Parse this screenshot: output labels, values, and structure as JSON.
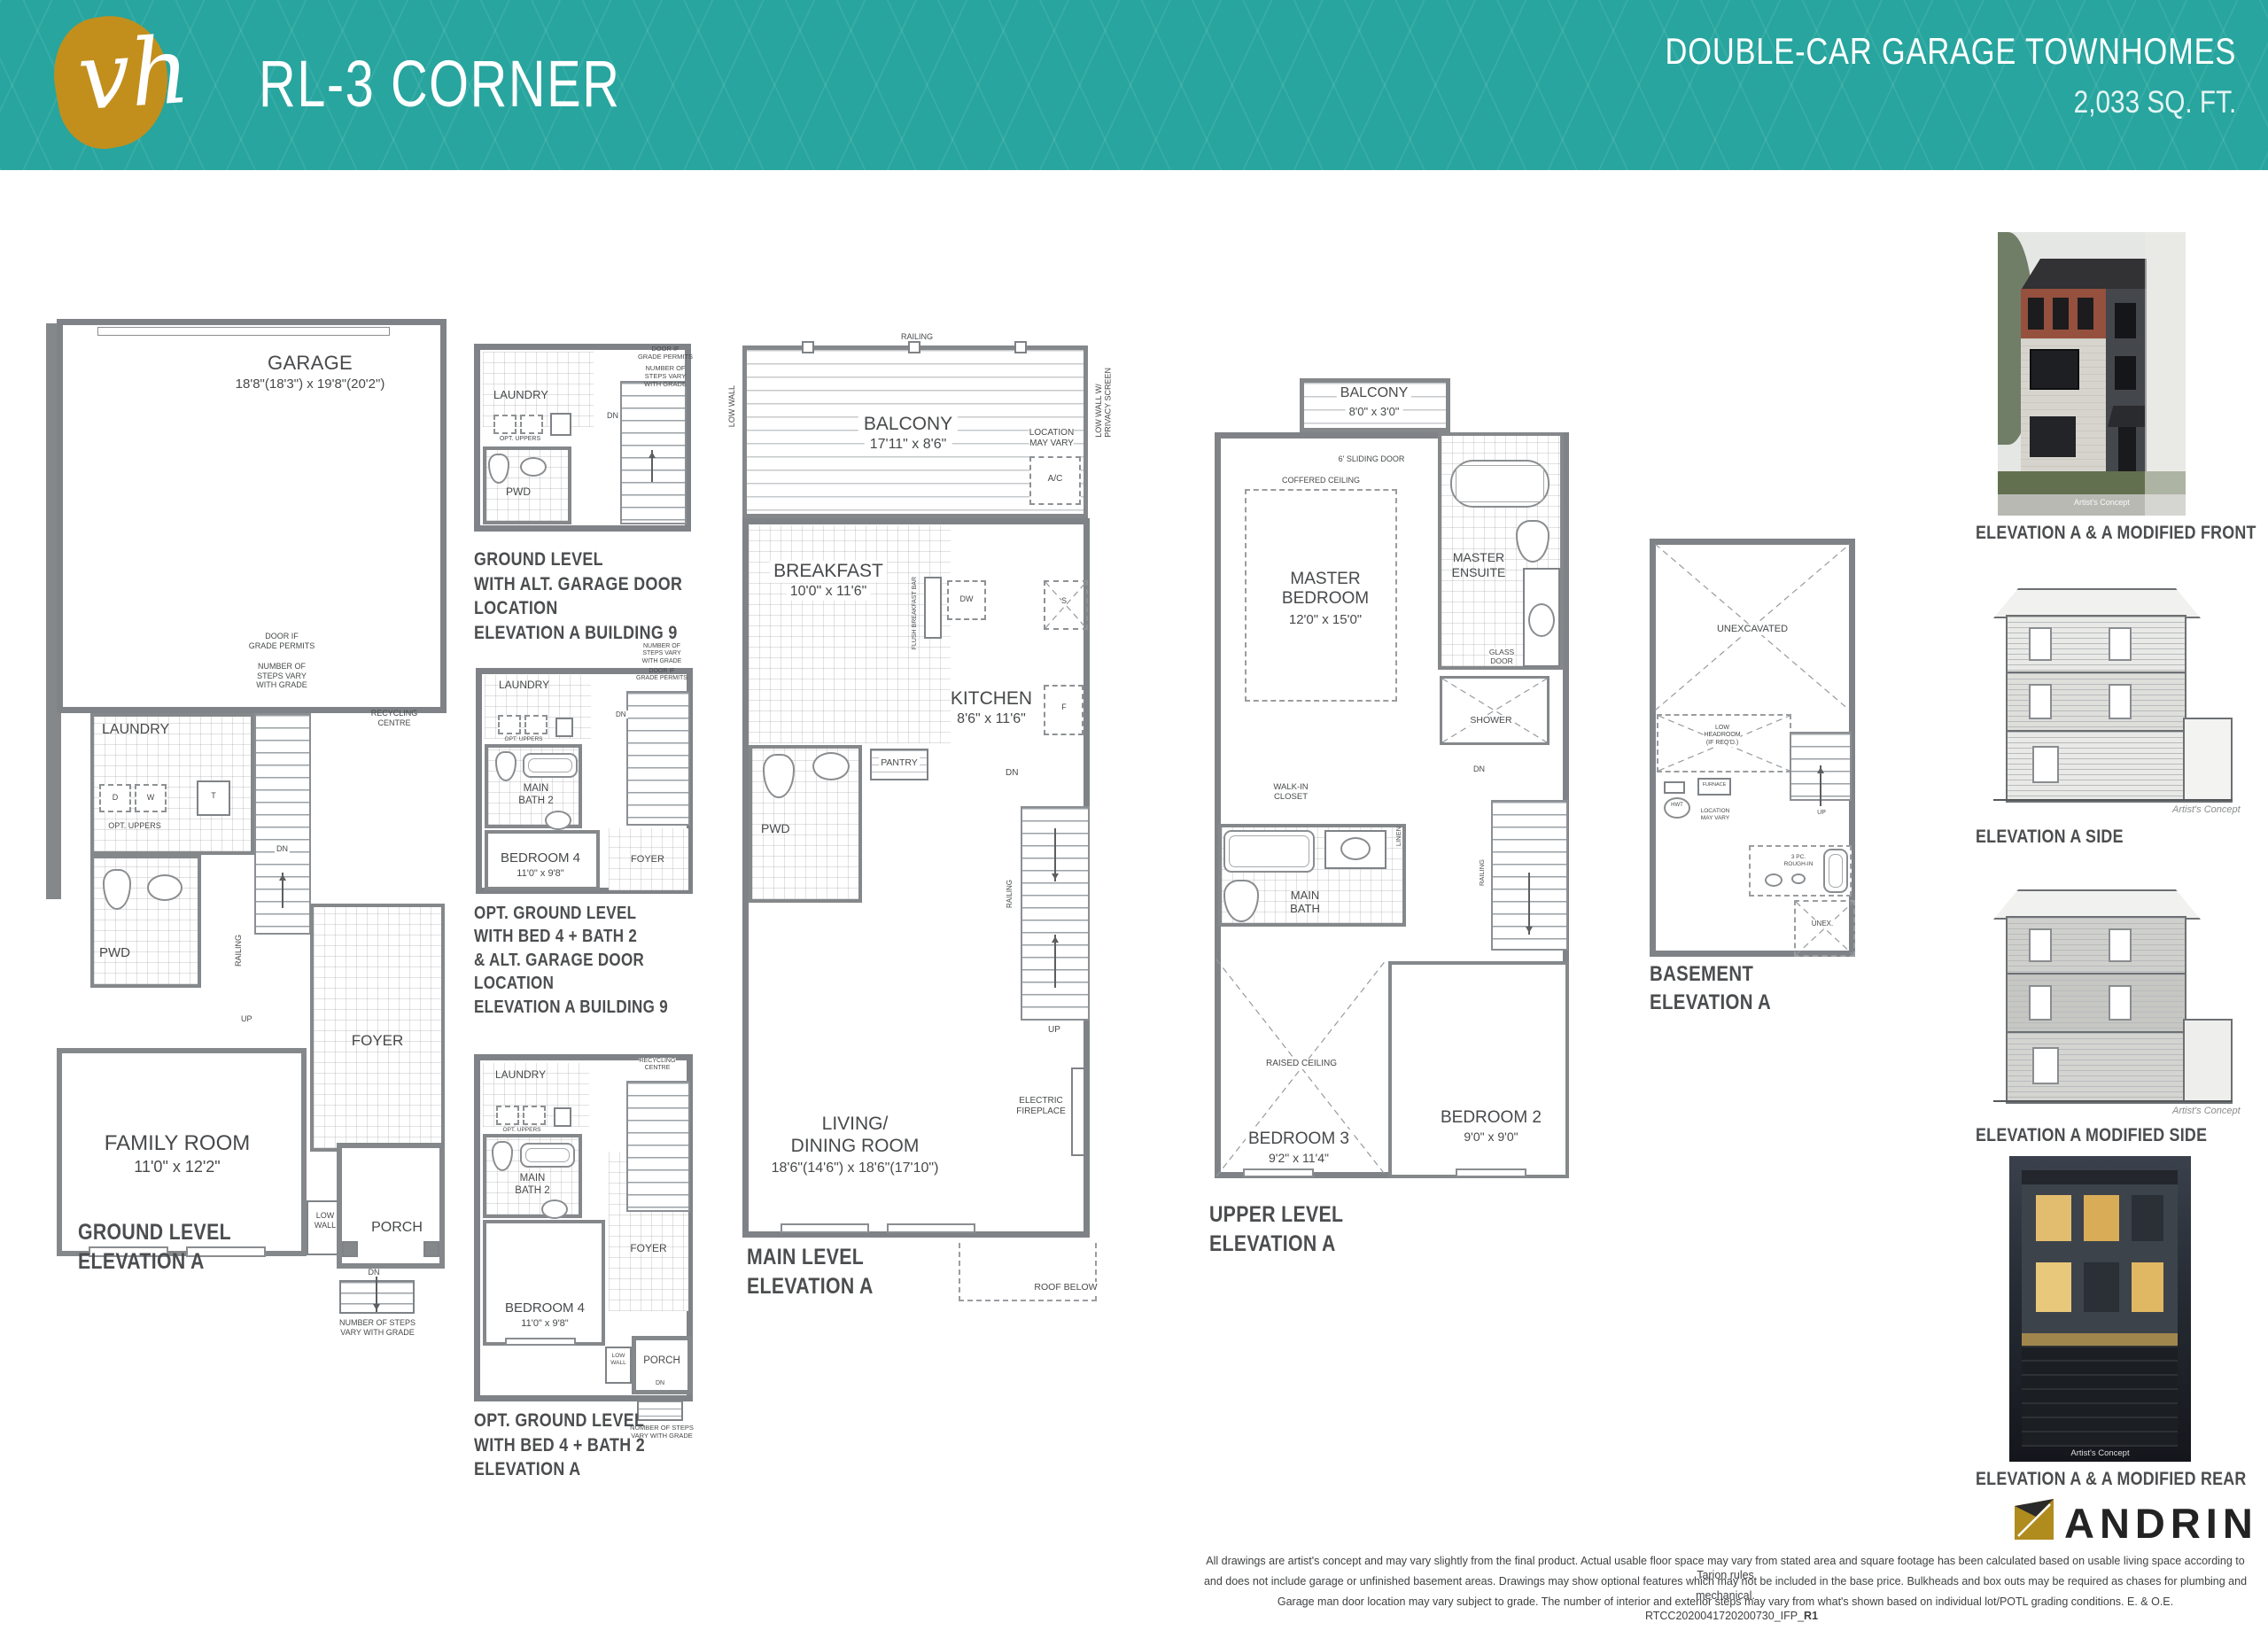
{
  "header": {
    "logo_text": "vh",
    "title": "RL-3 CORNER",
    "product": "DOUBLE-CAR GARAGE TOWNHOMES",
    "area": "2,033 SQ. FT."
  },
  "colors": {
    "teal": "#27a59e",
    "gold": "#c28f1d",
    "wall_gray": "#7f8387",
    "andrin_gold": "#b08c1e"
  },
  "common": {
    "laundry": "LAUNDRY",
    "pwd": "PWD",
    "foyer": "FOYER",
    "porch": "PORCH",
    "balcony": "BALCONY",
    "dn": "DN",
    "up": "UP",
    "railing": "RAILING",
    "d": "D",
    "w": "W",
    "t": "T",
    "f": "F",
    "s": "S",
    "dw": "DW",
    "opt_uppers": "OPT. UPPERS",
    "low_wall": "LOW\nWALL",
    "half_wall": "HALF\nWALL",
    "steps_vary": "NUMBER OF\nSTEPS VARY\nWITH GRADE",
    "steps_vary_wide": "NUMBER OF STEPS\nVARY WITH GRADE",
    "door_grade": "DOOR IF\nGRADE PERMITS",
    "recycling": "RECYCLING\nCENTRE",
    "main_bath2": "MAIN\nBATH 2",
    "bedroom4": "BEDROOM 4",
    "bedroom4_dims": "11'0\" x 9'8\"",
    "sliding_door": "6' SLIDING DOOR",
    "artists_concept": "Artist's Concept"
  },
  "ground": {
    "garage": "GARAGE",
    "garage_dims": "18'8\"(18'3\") x 19'8\"(20'2\")",
    "family": "FAMILY ROOM",
    "family_dims": "11'0\" x 12'2\"",
    "caption": "GROUND LEVEL\nELEVATION A"
  },
  "alt1": {
    "caption": "GROUND LEVEL\nWITH ALT. GARAGE DOOR LOCATION\nELEVATION A BUILDING 9"
  },
  "alt2": {
    "caption": "OPT. GROUND LEVEL\nWITH BED 4 + BATH 2\n& ALT. GARAGE DOOR LOCATION\nELEVATION A BUILDING 9"
  },
  "alt3": {
    "caption": "OPT. GROUND LEVEL\nWITH BED 4 + BATH 2\nELEVATION A"
  },
  "main": {
    "balcony_dims": "17'11\" x 8'6\"",
    "low_wall": "LOW WALL",
    "low_wall_privacy": "LOW WALL W/\nPRIVACY SCREEN",
    "location_vary": "LOCATION\nMAY VARY",
    "ac": "A/C",
    "breakfast": "BREAKFAST",
    "breakfast_dims": "10'0\" x 11'6\"",
    "flush_bar": "FLUSH BREAKFAST BAR",
    "kitchen": "KITCHEN",
    "kitchen_dims": "8'6\" x 11'6\"",
    "pantry": "PANTRY",
    "living": "LIVING/\nDINING ROOM",
    "living_dims": "18'6\"(14'6\") x 18'6\"(17'10\")",
    "fireplace": "ELECTRIC\nFIREPLACE",
    "roof_below": "ROOF BELOW",
    "caption": "MAIN LEVEL\nELEVATION A"
  },
  "upper": {
    "balcony_dims": "8'0\" x 3'0\"",
    "coffered": "COFFERED CEILING",
    "master": "MASTER\nBEDROOM",
    "master_dims": "12'0\" x 15'0\"",
    "ensuite": "MASTER\nENSUITE",
    "glass_door": "GLASS\nDOOR",
    "shower": "SHOWER",
    "wic": "WALK-IN\nCLOSET",
    "linen": "LINEN",
    "main_bath": "MAIN\nBATH",
    "raised": "RAISED CEILING",
    "bed3": "BEDROOM 3",
    "bed3_dims": "9'2\" x 11'4\"",
    "bed2": "BEDROOM 2",
    "bed2_dims": "9'0\" x 9'0\"",
    "caption": "UPPER LEVEL\nELEVATION A"
  },
  "basement": {
    "unexcavated": "UNEXCAVATED",
    "low_headroom": "LOW\nHEADROOM\n(IF REQ'D.)",
    "hwt": "HWT",
    "furnace": "FURNACE",
    "location_vary": "LOCATION\nMAY VARY",
    "roughin": "3 PC.\nROUGH-IN",
    "unex": "UNEX.",
    "caption": "BASEMENT\nELEVATION A"
  },
  "elevations": {
    "front_caption": "ELEVATION A & A MODIFIED FRONT",
    "side_caption": "ELEVATION A SIDE",
    "modside_caption": "ELEVATION A MODIFIED SIDE",
    "rear_caption": "ELEVATION A & A MODIFIED REAR"
  },
  "footer": {
    "brand": "ANDRIN",
    "line1": "All drawings are artist's concept and may vary slightly from the final product. Actual usable floor space may vary from stated area and square footage has been calculated based on usable living space according to Tarion rules",
    "line2": "and does not include garage or unfinished basement areas. Drawings may show optional features which may not be included in the base price. Bulkheads and box outs may be required as chases for plumbing and mechanical.",
    "line3": "Garage man door location may vary subject to grade. The number of interior and exterior steps may vary from what's shown based on individual lot/POTL grading conditions. E. & O.E.",
    "doc_code": "RTCC2020041720200730_IFP_",
    "doc_rev": "R1"
  }
}
